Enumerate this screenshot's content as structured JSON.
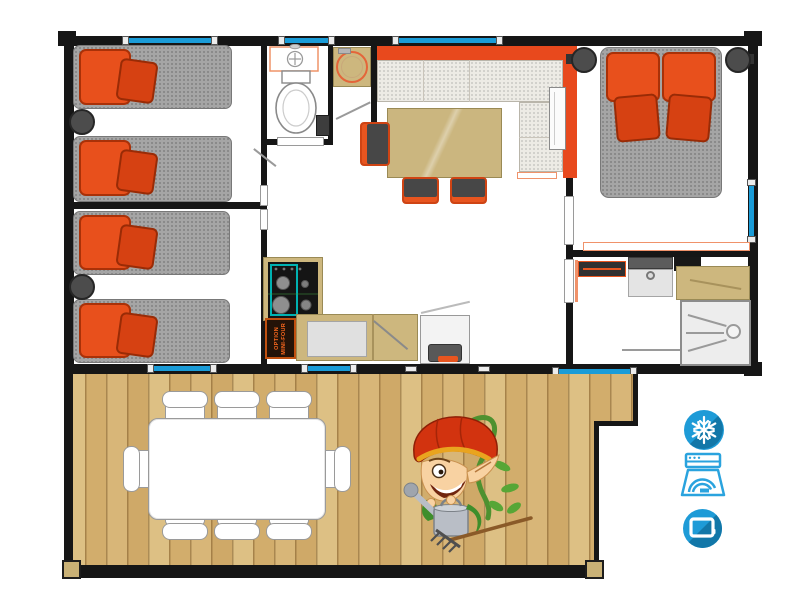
{
  "labels": {
    "mini_oven": {
      "line1": "OPTION",
      "line2": "MINI-FOUR"
    }
  },
  "amenities": {
    "items": [
      {
        "name": "air-conditioning",
        "icon": "snowflake-icon"
      },
      {
        "name": "dishwasher",
        "icon": "dishwasher-icon"
      },
      {
        "name": "television",
        "icon": "tv-icon"
      }
    ]
  },
  "floorplan_summary": {
    "single_beds": 4,
    "double_beds": 1,
    "terrace_chairs": 8,
    "rooms": 7
  },
  "colors": {
    "accent_orange": "#e8491d",
    "window_blue": "#1a9cd8",
    "icon_blue": "#1e9bd7",
    "icon_blue_dark": "#1277a8",
    "wood": "#d9b97e",
    "counter_tan": "#cdb77e",
    "mattress_gray": "#a5a5a5",
    "wall_black": "#161616",
    "hob_teal": "#00b2b2"
  }
}
